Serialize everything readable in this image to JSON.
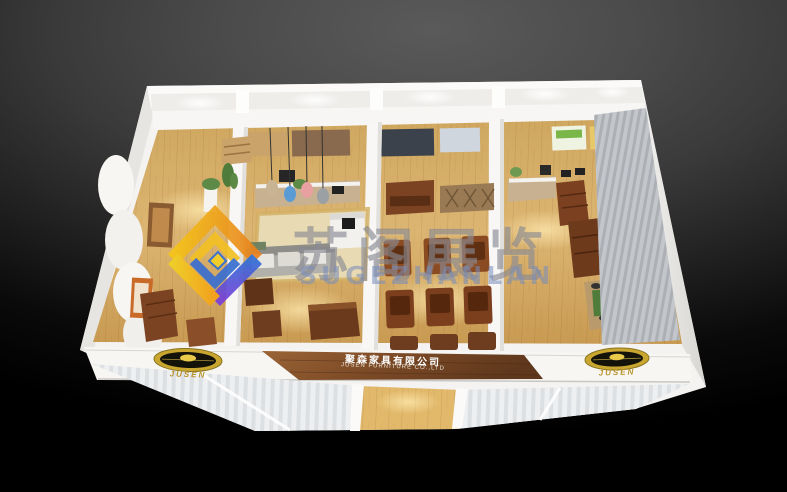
{
  "scene": {
    "description": "Aerial 3D rendering of a white exhibition booth furniture showroom with four room vignettes, wooden floors and front fascia signage"
  },
  "watermark": {
    "cn": "苏阁展览",
    "en": "SUGEZHANLAN",
    "logo_colors": {
      "gold": "#f2bc24",
      "orange": "#e8821e",
      "blue": "#2f6fd6",
      "purple": "#7a3fd8"
    }
  },
  "fascia": {
    "sign_cn": "聚森家具有限公司",
    "sign_en": "JUSEN FURNITURE CO.,LTD",
    "left_logo_text": "JUSEN",
    "right_logo_text": "JUSEN",
    "logo_gold": "#c9a62f",
    "sign_wood": "#7c4a26"
  },
  "palette": {
    "background_top": "#5a5a5a",
    "background_bottom": "#000000",
    "wall_white": "#f4f3f1",
    "floor_wood": "#d9b271",
    "furniture_wood": "#7c4322",
    "sofa_gray": "#b5b3ae",
    "rug_beige": "#e6d7ae",
    "blind_gray": "#bfc3c7"
  }
}
